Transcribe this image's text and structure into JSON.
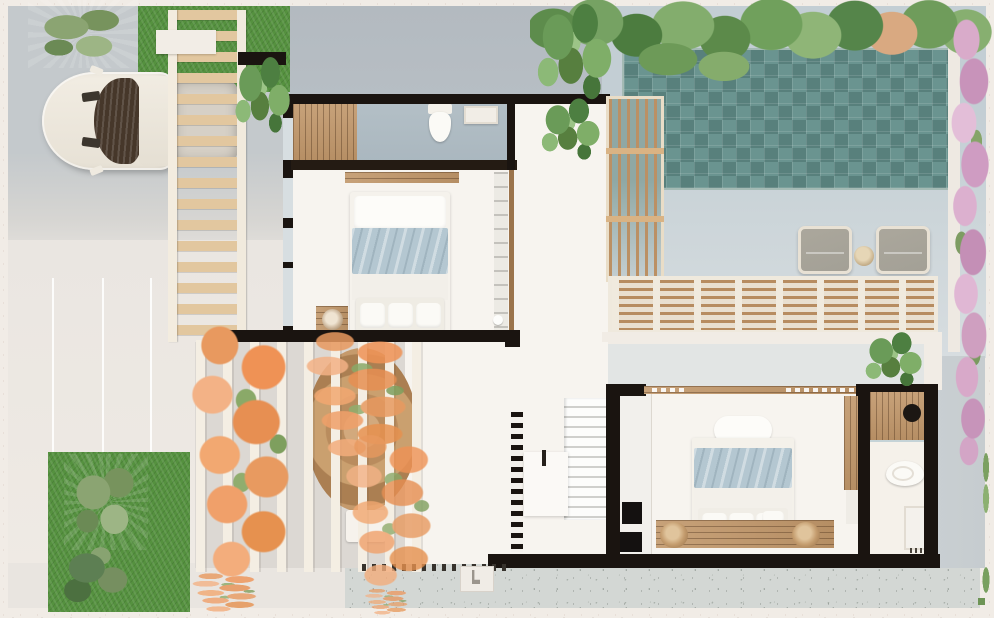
{
  "scene": {
    "type": "architectural-floor-plan-render",
    "view": "top-down",
    "text_content": "none — image contains no visible text or UI labels",
    "areas": [
      "driveway-carport",
      "front-lawn",
      "entry",
      "bathroom-1",
      "bedroom-1",
      "hallway",
      "pool-hedge",
      "swimming-pool",
      "pool-deck",
      "sun-lounger-zone",
      "timber-trellis",
      "slat-screen",
      "dining-pergola",
      "living-area",
      "staircase",
      "bedroom-2",
      "closet",
      "bathroom-2",
      "rear-path",
      "side-path",
      "rear-lawn",
      "bougainvillea-orange",
      "bougainvillea-pink"
    ],
    "objects": {
      "cars": 1,
      "beds": 2,
      "toilets": 2,
      "sinks": 2,
      "sun_loungers": 2,
      "side_tables": 3,
      "staircases": 1,
      "pools": 1
    }
  },
  "palette": {
    "frame": "#f1ece6",
    "driveway": "#c4c9cc",
    "sideyard": "#b7bec4",
    "pale": "#eae6e1",
    "terrazzo": "#d3d7d4",
    "path-gray": "#c6cccf",
    "grass": "#55913f",
    "pool": "#628e8a",
    "deck": "#ccd5d9",
    "wall": "#1a1410",
    "interior": "#f7f4ef",
    "bath-floor": "#aab7bf",
    "wood": "#c1976a",
    "wood-light": "#e2c79f",
    "wood-dark": "#9b744c",
    "blanket": "#b4c7d1",
    "chair": "#a3a096",
    "pink": "#d5a7c6",
    "orange": "#e8995f",
    "glass": "#d7dee1"
  }
}
